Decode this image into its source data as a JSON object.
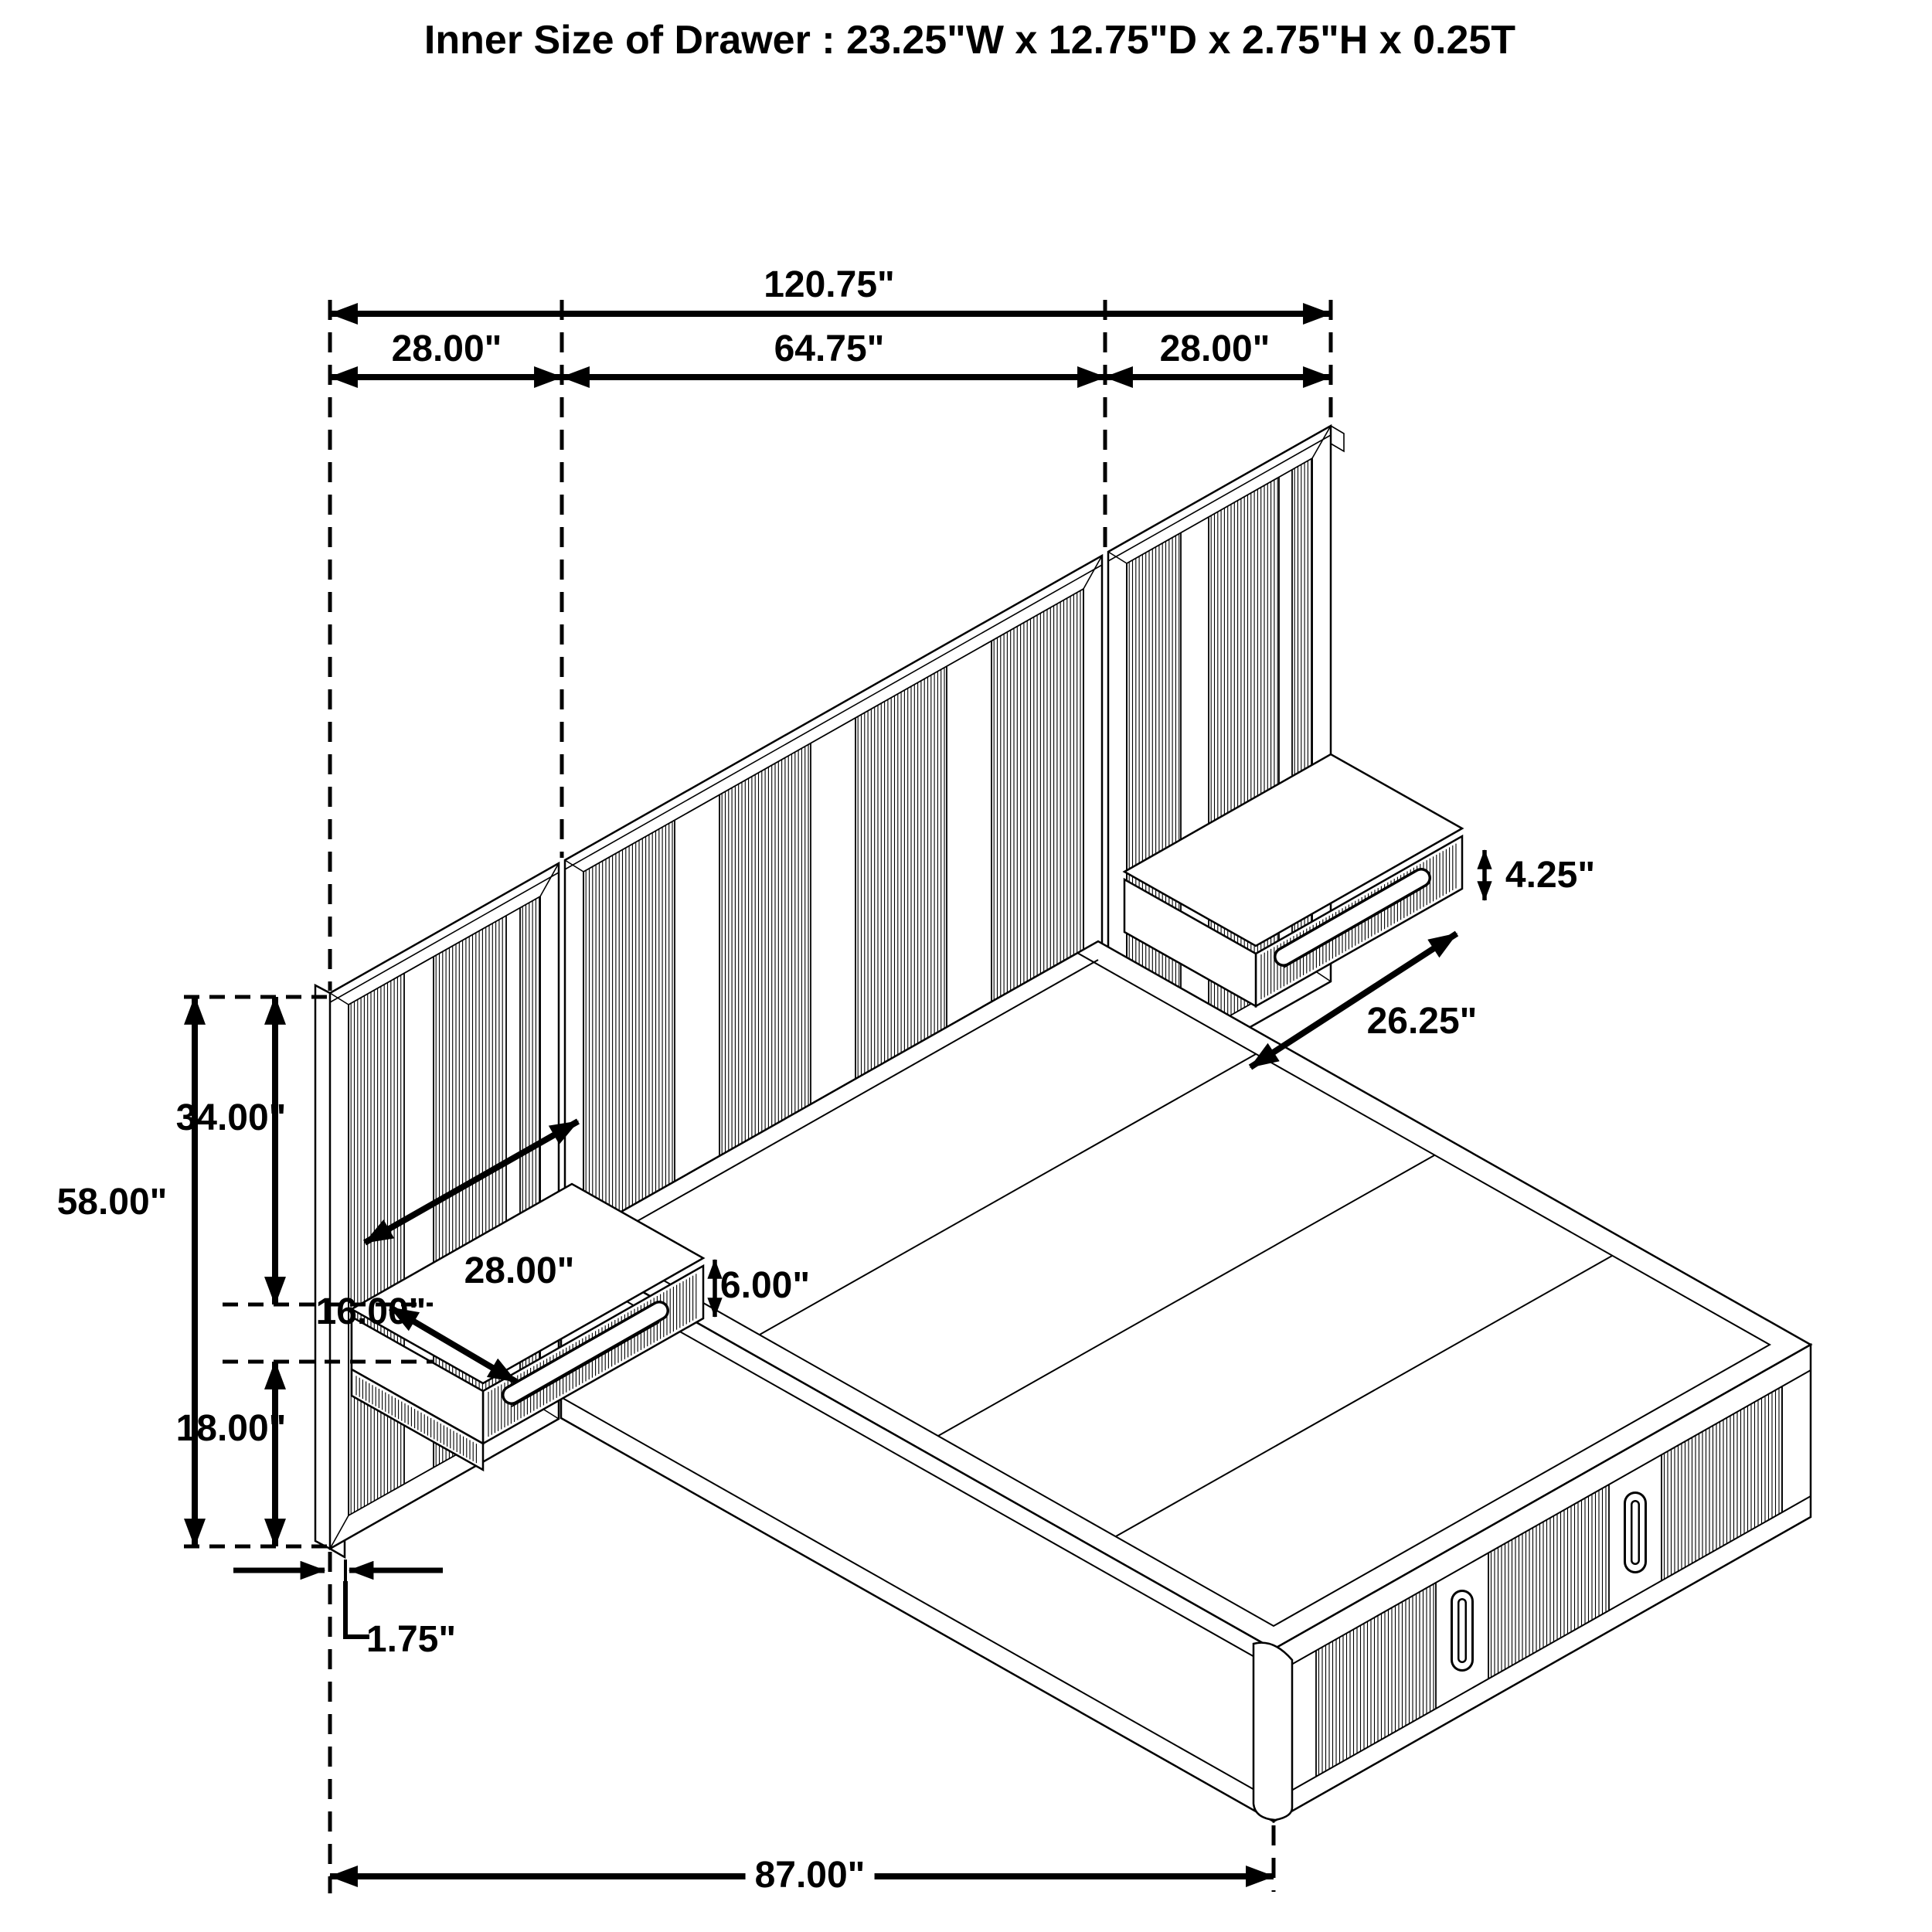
{
  "title": "Inner Size of Drawer : 23.25\"W x 12.75\"D x 2.75\"H x 0.25T",
  "dimensions": {
    "overall_width": "120.75\"",
    "left_panel_width": "28.00\"",
    "headboard_width": "64.75\"",
    "right_panel_width": "28.00\"",
    "right_nightstand_height": "4.25\"",
    "right_nightstand_width": "26.25\"",
    "panel_upper_height": "34.00\"",
    "panel_total_height": "58.00\"",
    "left_nightstand_width": "28.00\"",
    "left_nightstand_height": "6.00\"",
    "nightstand_depth": "16.00\"",
    "panel_lower_height": "18.00\"",
    "panel_thickness": "1.75\"",
    "bed_length": "87.00\""
  }
}
